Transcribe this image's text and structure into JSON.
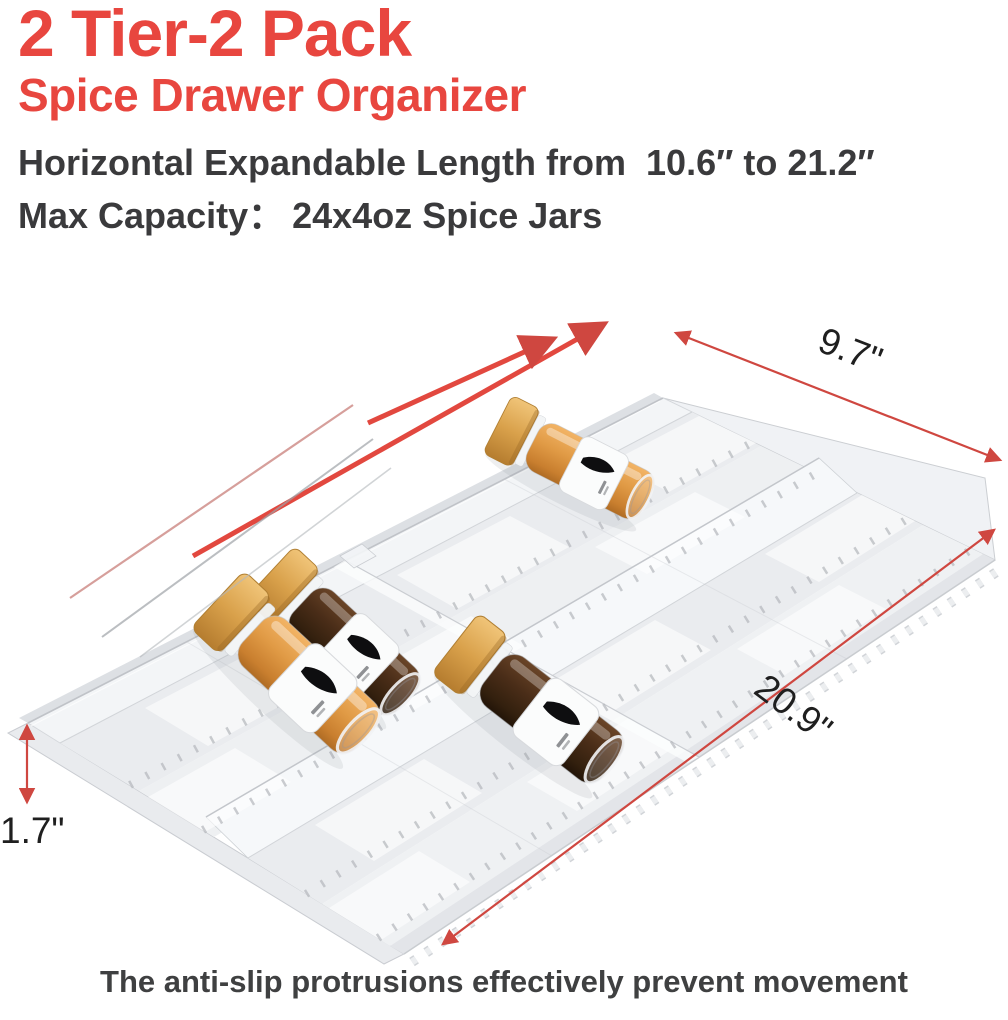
{
  "header": {
    "title": "2 Tier-2 Pack",
    "subtitle": "Spice Drawer Organizer",
    "feature_expandable_label": "Horizontal Expandable Length from",
    "feature_expandable_range": "10.6″ to 21.2″",
    "capacity_label": "Max Capacity：",
    "capacity_value": "24x4oz Spice Jars"
  },
  "annotations": {
    "width_label": "9.7\"",
    "length_label": "20.9\"",
    "height_label": "1.7\""
  },
  "product": {
    "type": "2-tier expandable clear spice drawer organizer, 2 pack",
    "jar_count": 4,
    "jar_spice_colors": [
      "#e09a45",
      "#40280f",
      "#e09a45",
      "#40280f"
    ],
    "jar_cap_color": "#d9a14b",
    "tray_color": "#eceef1"
  },
  "footer": {
    "caption": "The anti-slip protrusions effectively prevent movement"
  },
  "colors": {
    "accent_red": "#e8463f",
    "annotation_red": "#cf4740",
    "text_dark": "#3a3a3c",
    "dimension_text": "#1f1f1f"
  }
}
